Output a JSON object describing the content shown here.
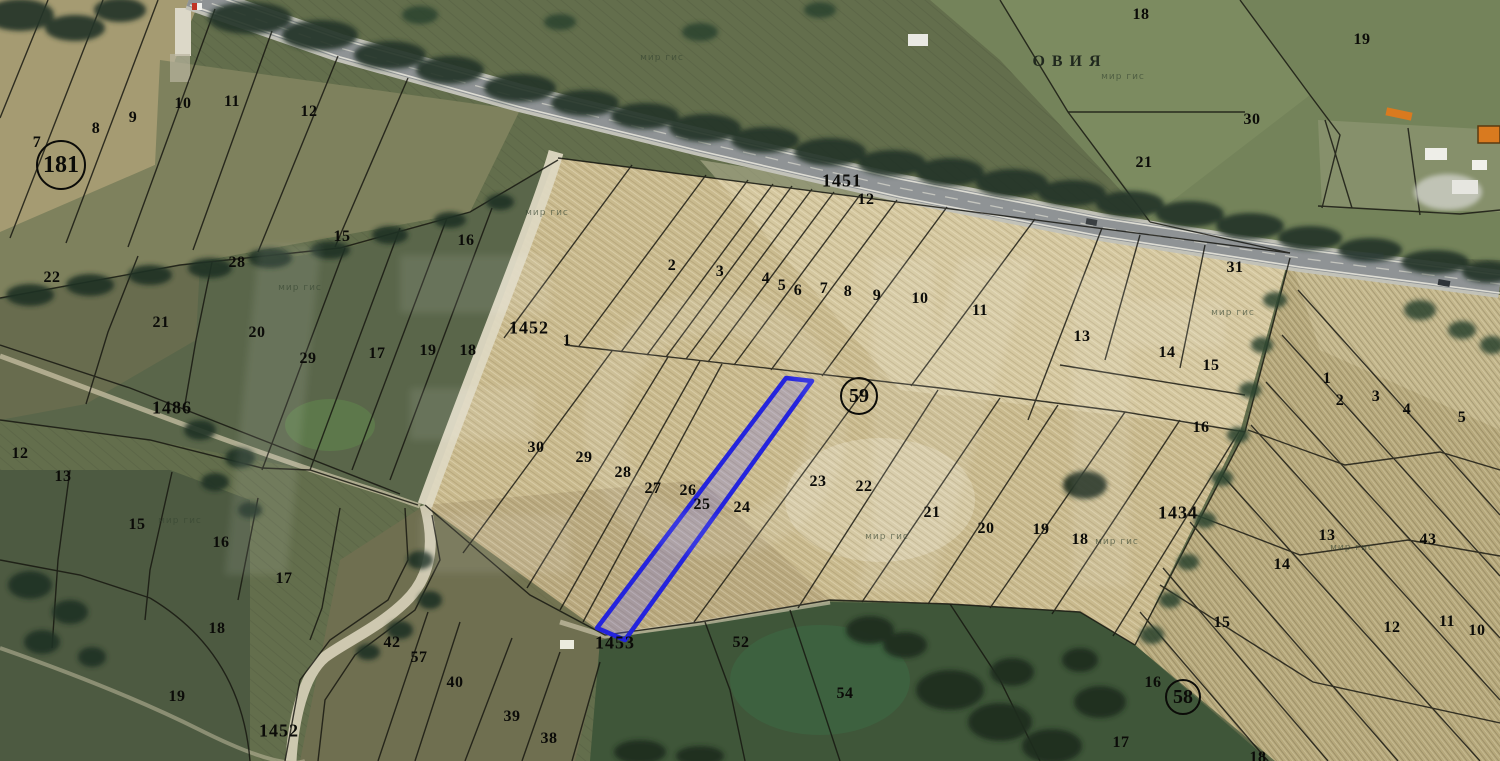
{
  "map": {
    "place": {
      "text": "ОВИЯ",
      "x": 1070,
      "y": 62
    },
    "watermark_small": "мир гис",
    "colors": {
      "highlight_stroke": "#2424dd",
      "highlight_fill": "rgba(110,110,255,0.25)",
      "boundary": "#14140e",
      "road": "#8f9395"
    },
    "labels": {
      "circled": [
        [
          "181",
          61,
          165,
          23,
          24
        ],
        [
          "59",
          859,
          396,
          17,
          20
        ],
        [
          "58",
          1183,
          697,
          16,
          20
        ]
      ],
      "roads": [
        [
          "1451",
          842,
          181
        ],
        [
          "1452",
          529,
          328
        ],
        [
          "1452",
          279,
          731
        ],
        [
          "1453",
          615,
          643
        ],
        [
          "1486",
          172,
          408
        ],
        [
          "1434",
          1178,
          513
        ]
      ],
      "parcels": [
        [
          "7",
          37,
          143
        ],
        [
          "8",
          96,
          129
        ],
        [
          "9",
          133,
          118
        ],
        [
          "10",
          183,
          104
        ],
        [
          "11",
          232,
          102
        ],
        [
          "12",
          309,
          112
        ],
        [
          "22",
          52,
          278
        ],
        [
          "28",
          237,
          263
        ],
        [
          "21",
          161,
          323
        ],
        [
          "20",
          257,
          333
        ],
        [
          "15",
          342,
          237
        ],
        [
          "16",
          466,
          241
        ],
        [
          "29",
          308,
          359
        ],
        [
          "17",
          377,
          354
        ],
        [
          "19",
          428,
          351
        ],
        [
          "18",
          468,
          351
        ],
        [
          "12",
          20,
          454
        ],
        [
          "13",
          63,
          477
        ],
        [
          "15",
          137,
          525
        ],
        [
          "16",
          221,
          543
        ],
        [
          "17",
          284,
          579
        ],
        [
          "18",
          217,
          629
        ],
        [
          "19",
          177,
          697
        ],
        [
          "42",
          392,
          643
        ],
        [
          "57",
          419,
          658
        ],
        [
          "40",
          455,
          683
        ],
        [
          "39",
          512,
          717
        ],
        [
          "38",
          549,
          739
        ],
        [
          "1",
          567,
          341
        ],
        [
          "2",
          672,
          266
        ],
        [
          "3",
          720,
          272
        ],
        [
          "4",
          766,
          279
        ],
        [
          "5",
          782,
          286
        ],
        [
          "6",
          798,
          291
        ],
        [
          "7",
          824,
          289
        ],
        [
          "8",
          848,
          292
        ],
        [
          "9",
          877,
          296
        ],
        [
          "10",
          920,
          299
        ],
        [
          "11",
          980,
          311
        ],
        [
          "12",
          866,
          200
        ],
        [
          "30",
          536,
          448
        ],
        [
          "29",
          584,
          458
        ],
        [
          "28",
          623,
          473
        ],
        [
          "27",
          653,
          489
        ],
        [
          "26",
          688,
          491
        ],
        [
          "25",
          702,
          505
        ],
        [
          "24",
          742,
          508
        ],
        [
          "23",
          818,
          482
        ],
        [
          "22",
          864,
          487
        ],
        [
          "31",
          1235,
          268
        ],
        [
          "13",
          1082,
          337
        ],
        [
          "14",
          1167,
          353
        ],
        [
          "15",
          1211,
          366
        ],
        [
          "16",
          1201,
          428
        ],
        [
          "1",
          1327,
          379
        ],
        [
          "2",
          1340,
          401
        ],
        [
          "3",
          1376,
          397
        ],
        [
          "4",
          1407,
          410
        ],
        [
          "5",
          1462,
          418
        ],
        [
          "21",
          932,
          513
        ],
        [
          "20",
          986,
          529
        ],
        [
          "19",
          1041,
          530
        ],
        [
          "18",
          1080,
          540
        ],
        [
          "13",
          1327,
          536
        ],
        [
          "43",
          1428,
          540
        ],
        [
          "14",
          1282,
          565
        ],
        [
          "15",
          1222,
          623
        ],
        [
          "12",
          1392,
          628
        ],
        [
          "11",
          1447,
          622
        ],
        [
          "10",
          1477,
          631
        ],
        [
          "16",
          1153,
          683
        ],
        [
          "17",
          1121,
          743
        ],
        [
          "18",
          1258,
          758
        ],
        [
          "18",
          1141,
          15
        ],
        [
          "19",
          1362,
          40
        ],
        [
          "30",
          1252,
          120
        ],
        [
          "21",
          1144,
          163
        ],
        [
          "52",
          741,
          643
        ],
        [
          "54",
          845,
          694
        ]
      ],
      "watermarks": [
        [
          300,
          288
        ],
        [
          547,
          213
        ],
        [
          662,
          58
        ],
        [
          1123,
          77
        ],
        [
          180,
          521
        ],
        [
          887,
          537
        ],
        [
          1117,
          542
        ],
        [
          1352,
          548
        ],
        [
          1233,
          313
        ]
      ]
    }
  }
}
